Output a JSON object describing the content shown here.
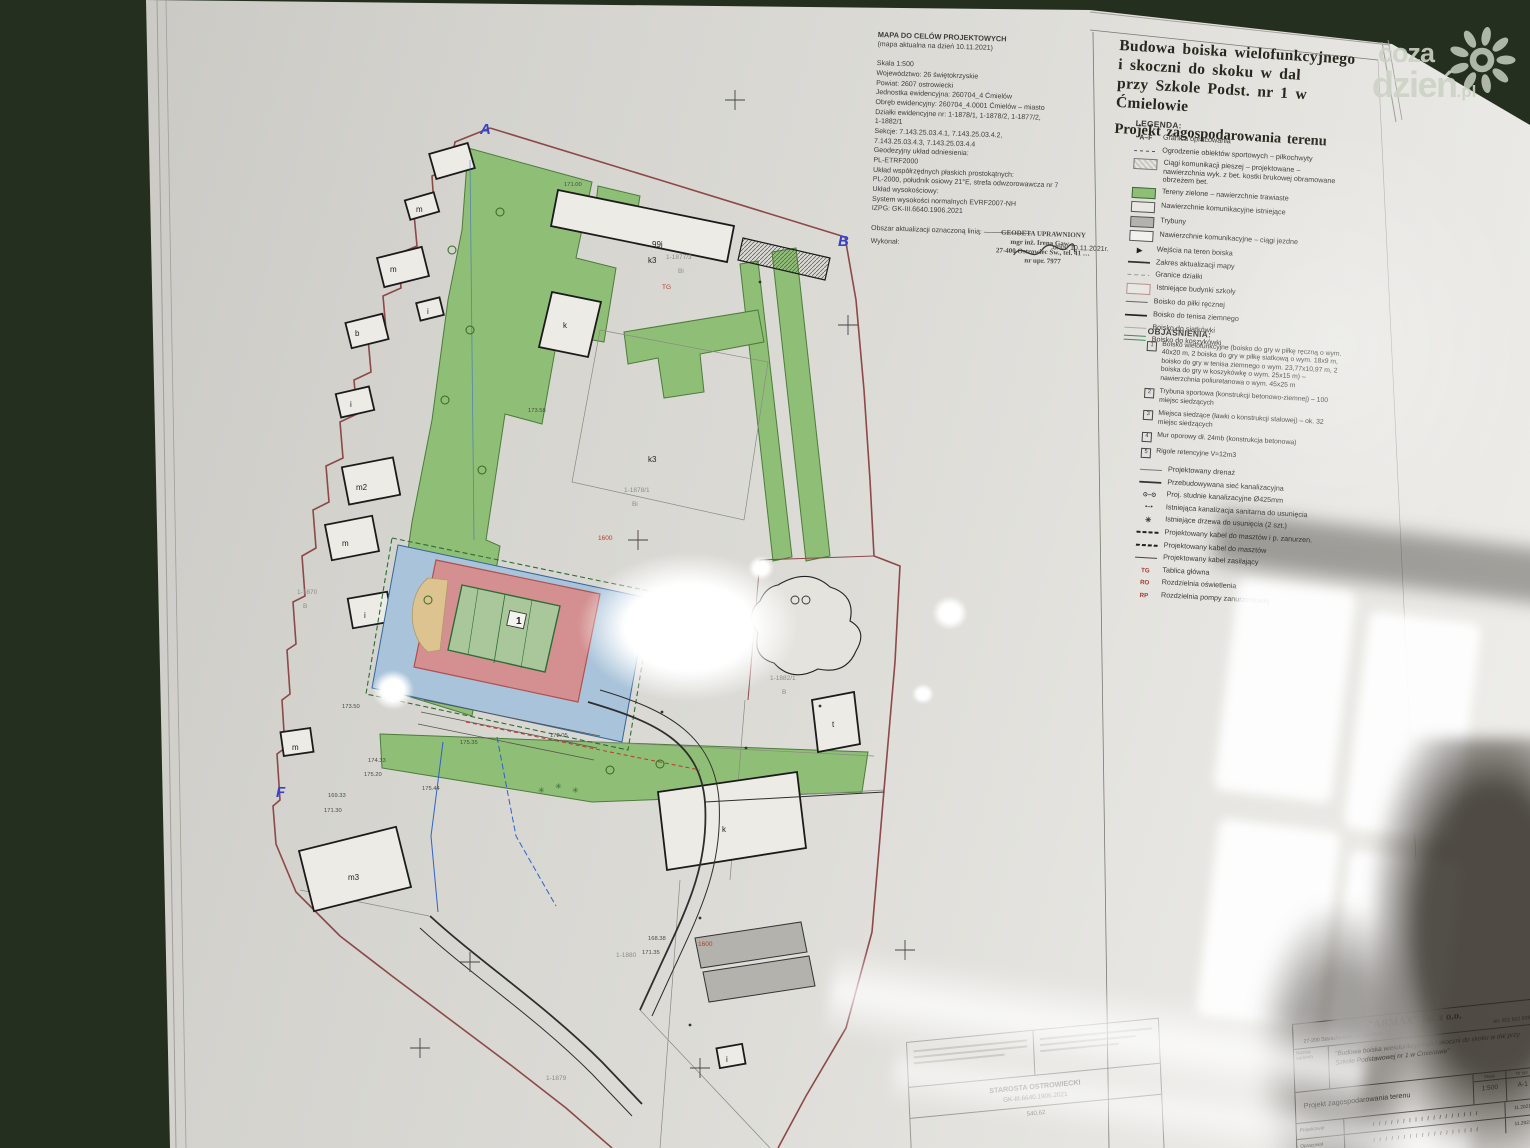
{
  "colors": {
    "background": "#242f1f",
    "paper": "#d9d8d3",
    "green_area": "#8fbe76",
    "field_red": "#d49090",
    "field_blue": "#a9c3da",
    "court_green": "#a9c79b",
    "boundary_red": "#8d4848",
    "marker_blue": "#3743c6"
  },
  "watermark": {
    "word1": "coza",
    "word2": "dzień",
    "suffix": ".pl",
    "icon": "sun-icon"
  },
  "sheet": {
    "meta_block": {
      "lines": [
        "MAPA DO CELÓW PROJEKTOWYCH",
        "(mapa aktualna na dzień 10.11.2021)",
        "",
        "Skala 1:500",
        "Województwo: 26 świętokrzyskie",
        "Powiat: 2607 ostrowiecki",
        "Jednostka ewidencyjna: 260704_4 Ćmielów",
        "Obręb ewidencyjny: 260704_4.0001 Ćmielów – miasto",
        "Działki ewidencyjne nr: 1-1878/1, 1-1878/2, 1-1877/2,",
        "1-1882/1",
        "Sekcje: 7.143.25.03.4.1, 7.143.25.03.4.2,",
        "7.143.25.03.4.3, 7.143.25.03.4.4",
        "Geodezyjny układ odniesienia:",
        "PL-ETRF2000",
        "Układ współrzędnych płaskich prostokątnych:",
        "PL-2000, południk osiowy 21°E, strefa odwzorowawcza nr 7",
        "Układ wysokościowy:",
        "System wysokości normalnych EVRF2007-NH",
        "IZPG: GK-III.6640.1906.2021",
        "",
        "Obszar aktualizacji oznaczoną linią:  ––––––––––––"
      ],
      "footer_left": "Wykonał:",
      "footer_right": "dnia: 10.11.2021r."
    },
    "surveyor_stamp": {
      "line1": "GEODETA UPRAWNIONY",
      "line2": "mgr inż. Irena Gaw…",
      "line3": "27-400 Ostrowiec Św., tel. 41 …",
      "line4": "nr upr. 7977"
    },
    "title_block": {
      "lines": [
        "Budowa boiska wielofunkcyjnego",
        "i skoczni do skoku w dal",
        "przy Szkole Podst. nr 1 w Ćmielowie"
      ],
      "subtitle": "Projekt zagospodarowania terenu"
    },
    "legend": {
      "heading": "LEGENDA:",
      "items": [
        {
          "sym": "af",
          "symtext": "A–F",
          "label": "Granica opracowania"
        },
        {
          "sym": "fence",
          "label": "Ogrodzenie obiektów sportowych – piłkochwyty"
        },
        {
          "sym": "paving",
          "label": "Ciągi komunikacji pieszej – projektowane – nawierzchnia wyk. z bet. kostki brukowej obramowane obrzeżem bet."
        },
        {
          "sym": "green",
          "label": "Tereny zielone – nawierzchnie trawiaste"
        },
        {
          "sym": "exist",
          "label": "Nawierzchnie komunikacyjne istniejące"
        },
        {
          "sym": "stands",
          "label": "Trybuny"
        },
        {
          "sym": "road",
          "label": "Nawierzchnie komunikacyjne – ciągi jezdne"
        },
        {
          "sym": "entry",
          "symtext": "▶",
          "label": "Wejścia na teren boiska"
        },
        {
          "sym": "scope",
          "label": "Zakres aktualizacji mapy"
        },
        {
          "sym": "parcel",
          "label": "Granice działki"
        },
        {
          "sym": "school",
          "label": "Istniejące budynki szkoły"
        },
        {
          "sym": "handball",
          "label": "Boisko do piłki ręcznej"
        },
        {
          "sym": "tennis",
          "label": "Boisko do tenisa ziemnego"
        },
        {
          "sym": "volley",
          "label": "Boisko do siatkówki"
        },
        {
          "sym": "basket",
          "label": "Boisko do koszykówki"
        }
      ]
    },
    "explanations": {
      "heading": "OBJAŚNIENIA:",
      "numbered": [
        "Boisko wielofunkcyjne (boisko do gry w piłkę ręczną o wym. 40x20 m, 2 boiska do gry w piłkę siatkową o wym. 18x9 m, boisko do gry w tenisa ziemnego o wym. 23,77x10,97 m, 2 boiska do gry w koszykówkę o wym. 25x15 m) – nawierzchnia poliuretanowa o wym. 45x25 m",
        "Trybuna sportowa (konstrukcji betonowo-ziemnej) – 100 miejsc siedzących",
        "Miejsca siedzące (ławki o konstrukcji stalowej) – ok. 32 miejsc siedzących",
        "Mur oporowy dł. 24mb (konstrukcja betonowa)",
        "Rigole retencyjne V=12m3"
      ],
      "symbols": [
        {
          "sym": "drain",
          "label": "Projektowany drenaż"
        },
        {
          "sym": "sewer",
          "label": "Przebudowywana sieć kanalizacyjna"
        },
        {
          "sym": "wells",
          "symtext": "⊙–⊙",
          "label": "Proj. studnie kanalizacyjne Ø425mm"
        },
        {
          "sym": "sanit",
          "symtext": "•–•",
          "label": "Istniejąca kanalizacja sanitarna do usunięcia"
        },
        {
          "sym": "trees",
          "symtext": "✳",
          "label": "Istniejące drzewa do usunięcia (2 szt.)"
        },
        {
          "sym": "cable1",
          "label": "Projektowany kabel do masztów i p. zanurzen."
        },
        {
          "sym": "cable2",
          "label": "Projektowany kabel do masztów"
        },
        {
          "sym": "cable3",
          "label": "Projektowany kabel zasilający"
        },
        {
          "sym": "tg",
          "symtext": "TG",
          "label": "Tablica główna"
        },
        {
          "sym": "ro",
          "symtext": "RO",
          "label": "Rozdzielnia oświetlenia"
        },
        {
          "sym": "rp",
          "symtext": "RP",
          "label": "Rozdzielnia pompy zanurzeniowej"
        }
      ]
    },
    "county_stamp": {
      "authority": "STAROSTA OSTROWIECKI",
      "case_no": "GK-III.6640.1906.2021",
      "value": "540,62"
    },
    "titleblock_armax": {
      "company": "\"ARMAX\" Sp. z o.o.",
      "address": "27-200 Starachowice, ul. 1go Maja 12",
      "phone": "tel. 602 602 608",
      "task_label": "Nazwa zadania",
      "task": "\"Budowa boiska wielofunkcyjnego i skoczni do skoku w dal przy Szkole Podstawowej nr 1 w Ćmielowie\"",
      "drawing_label": "Tytuł rys.",
      "drawing": "Projekt zagospodarowania terenu",
      "scale_label": "Skala",
      "scale": "1:500",
      "sheet_label": "Nr rys.",
      "sheet": "A-1",
      "role1": "Projektował",
      "role2": "Opracował",
      "date": "11.2021"
    }
  },
  "map": {
    "field_number": "1",
    "labels": [
      {
        "t": "A",
        "x": 480,
        "y": 134,
        "c": "mk"
      },
      {
        "t": "B",
        "x": 838,
        "y": 246,
        "c": "mk"
      },
      {
        "t": "F",
        "x": 276,
        "y": 797,
        "c": "mk"
      },
      {
        "t": "m",
        "x": 416,
        "y": 212,
        "c": "b"
      },
      {
        "t": "m",
        "x": 390,
        "y": 272,
        "c": "b"
      },
      {
        "t": "b",
        "x": 355,
        "y": 336,
        "c": "b"
      },
      {
        "t": "i",
        "x": 427,
        "y": 314,
        "c": "b"
      },
      {
        "t": "i",
        "x": 350,
        "y": 407,
        "c": "b"
      },
      {
        "t": "m2",
        "x": 356,
        "y": 490,
        "c": "b"
      },
      {
        "t": "m",
        "x": 342,
        "y": 546,
        "c": "b"
      },
      {
        "t": "i",
        "x": 364,
        "y": 618,
        "c": "b"
      },
      {
        "t": "m",
        "x": 292,
        "y": 750,
        "c": "b"
      },
      {
        "t": "m3",
        "x": 348,
        "y": 880,
        "c": "b"
      },
      {
        "t": "99j",
        "x": 652,
        "y": 247,
        "c": "b"
      },
      {
        "t": "k3",
        "x": 648,
        "y": 263,
        "c": "b"
      },
      {
        "t": "k",
        "x": 563,
        "y": 328,
        "c": "b"
      },
      {
        "t": "k3",
        "x": 648,
        "y": 462,
        "c": "b"
      },
      {
        "t": "k",
        "x": 722,
        "y": 832,
        "c": "b"
      },
      {
        "t": "t",
        "x": 832,
        "y": 727,
        "c": "b"
      },
      {
        "t": "i",
        "x": 726,
        "y": 1062,
        "c": "b"
      },
      {
        "t": "1-1877/3",
        "x": 666,
        "y": 259,
        "c": "g"
      },
      {
        "t": "Bi",
        "x": 678,
        "y": 273,
        "c": "g"
      },
      {
        "t": "1-1878/1",
        "x": 624,
        "y": 492,
        "c": "g"
      },
      {
        "t": "Bi",
        "x": 632,
        "y": 506,
        "c": "g"
      },
      {
        "t": "1-1882/1",
        "x": 770,
        "y": 680,
        "c": "g"
      },
      {
        "t": "B",
        "x": 782,
        "y": 694,
        "c": "g"
      },
      {
        "t": "1-1870",
        "x": 297,
        "y": 594,
        "c": "g"
      },
      {
        "t": "B",
        "x": 303,
        "y": 608,
        "c": "g"
      },
      {
        "t": "1-1880",
        "x": 616,
        "y": 957,
        "c": "g"
      },
      {
        "t": "1-1879",
        "x": 546,
        "y": 1080,
        "c": "g"
      },
      {
        "t": "1600",
        "x": 598,
        "y": 540,
        "c": "r"
      },
      {
        "t": "TG",
        "x": 662,
        "y": 289,
        "c": "r"
      },
      {
        "t": "1600",
        "x": 698,
        "y": 946,
        "c": "r"
      },
      {
        "t": "171.00",
        "x": 564,
        "y": 186,
        "c": "e"
      },
      {
        "t": "173.58",
        "x": 528,
        "y": 412,
        "c": "e"
      },
      {
        "t": "173.50",
        "x": 342,
        "y": 708,
        "c": "e"
      },
      {
        "t": "169.33",
        "x": 328,
        "y": 797,
        "c": "e"
      },
      {
        "t": "171.30",
        "x": 324,
        "y": 812,
        "c": "e"
      },
      {
        "t": "174.33",
        "x": 368,
        "y": 762,
        "c": "e"
      },
      {
        "t": "175.20",
        "x": 364,
        "y": 776,
        "c": "e"
      },
      {
        "t": "175.44",
        "x": 422,
        "y": 790,
        "c": "e"
      },
      {
        "t": "175.35",
        "x": 460,
        "y": 744,
        "c": "e"
      },
      {
        "t": "172.05",
        "x": 550,
        "y": 737,
        "c": "e"
      },
      {
        "t": "168.38",
        "x": 648,
        "y": 940,
        "c": "e"
      },
      {
        "t": "171.35",
        "x": 642,
        "y": 954,
        "c": "e"
      },
      {
        "t": "✳",
        "x": 538,
        "y": 793,
        "c": "tr"
      },
      {
        "t": "✳",
        "x": 555,
        "y": 789,
        "c": "tr"
      },
      {
        "t": "✳",
        "x": 572,
        "y": 793,
        "c": "tr"
      },
      {
        "t": "1",
        "x": 516,
        "y": 624,
        "c": "n1"
      }
    ]
  }
}
